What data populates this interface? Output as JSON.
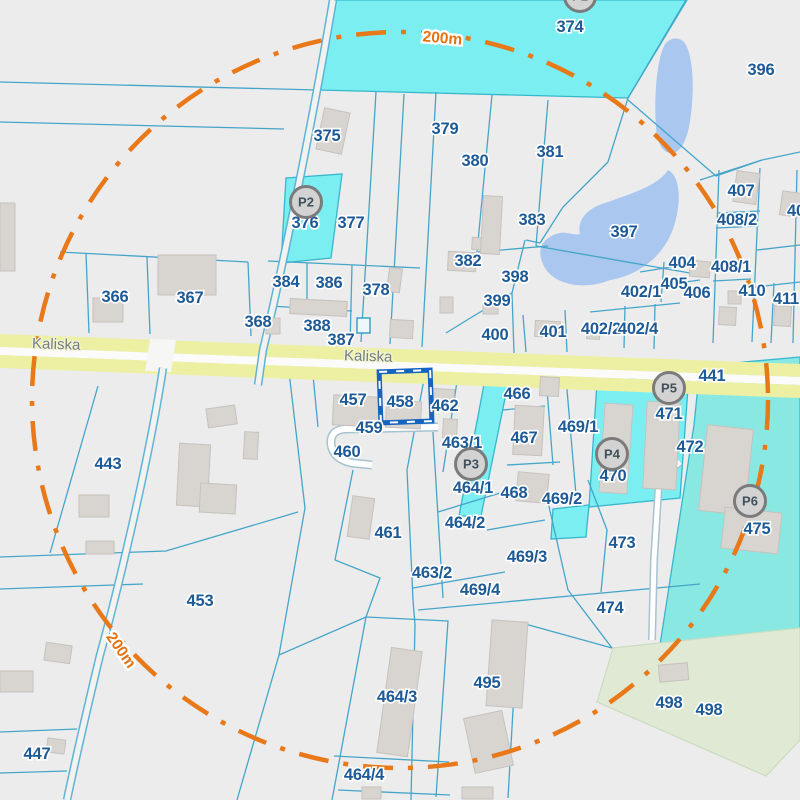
{
  "map": {
    "road": {
      "name": "Kaliska",
      "labels": [
        {
          "text": "Kaliska",
          "x": 56,
          "y": 349,
          "rotate": 2
        },
        {
          "text": "Kaliska",
          "x": 368,
          "y": 361,
          "rotate": 2
        }
      ]
    },
    "ring": {
      "radius_text": "200m",
      "labels": [
        {
          "text": "200m",
          "x": 442,
          "y": 43,
          "rotate": 5
        },
        {
          "text": "200m",
          "x": 117,
          "y": 653,
          "rotate": 55
        }
      ]
    },
    "selected_parcel": "458",
    "markers": [
      {
        "label": "P1",
        "x": 580,
        "y": -4
      },
      {
        "label": "P2",
        "x": 306,
        "y": 202
      },
      {
        "label": "P3",
        "x": 471,
        "y": 464
      },
      {
        "label": "P4",
        "x": 612,
        "y": 454
      },
      {
        "label": "P5",
        "x": 669,
        "y": 388
      },
      {
        "label": "P6",
        "x": 750,
        "y": 501
      }
    ],
    "parcels": [
      {
        "label": "374",
        "x": 570,
        "y": 32
      },
      {
        "label": "396",
        "x": 761,
        "y": 75
      },
      {
        "label": "375",
        "x": 327,
        "y": 141
      },
      {
        "label": "379",
        "x": 445,
        "y": 134
      },
      {
        "label": "380",
        "x": 475,
        "y": 166
      },
      {
        "label": "381",
        "x": 550,
        "y": 157
      },
      {
        "label": "376",
        "x": 305,
        "y": 228
      },
      {
        "label": "377",
        "x": 351,
        "y": 228
      },
      {
        "label": "383",
        "x": 532,
        "y": 225
      },
      {
        "label": "397",
        "x": 624,
        "y": 237
      },
      {
        "label": "382",
        "x": 468,
        "y": 266
      },
      {
        "label": "398",
        "x": 515,
        "y": 282
      },
      {
        "label": "399",
        "x": 497,
        "y": 306
      },
      {
        "label": "400",
        "x": 495,
        "y": 340
      },
      {
        "label": "401",
        "x": 553,
        "y": 337
      },
      {
        "label": "402/1",
        "x": 641,
        "y": 297
      },
      {
        "label": "402/2",
        "x": 601,
        "y": 334
      },
      {
        "label": "402/4",
        "x": 638,
        "y": 334
      },
      {
        "label": "404",
        "x": 682,
        "y": 268
      },
      {
        "label": "405",
        "x": 674,
        "y": 289
      },
      {
        "label": "406",
        "x": 697,
        "y": 298
      },
      {
        "label": "407",
        "x": 741,
        "y": 196
      },
      {
        "label": "408/2",
        "x": 737,
        "y": 225
      },
      {
        "label": "408/1",
        "x": 731,
        "y": 272
      },
      {
        "label": "410",
        "x": 752,
        "y": 296
      },
      {
        "label": "411",
        "x": 786,
        "y": 304
      },
      {
        "label": "40",
        "x": 796,
        "y": 216
      },
      {
        "label": "366",
        "x": 115,
        "y": 302
      },
      {
        "label": "367",
        "x": 190,
        "y": 303
      },
      {
        "label": "368",
        "x": 258,
        "y": 327
      },
      {
        "label": "384",
        "x": 286,
        "y": 287
      },
      {
        "label": "386",
        "x": 329,
        "y": 288
      },
      {
        "label": "378",
        "x": 376,
        "y": 295
      },
      {
        "label": "388",
        "x": 317,
        "y": 331
      },
      {
        "label": "387",
        "x": 341,
        "y": 345
      },
      {
        "label": "441",
        "x": 712,
        "y": 381
      },
      {
        "label": "457",
        "x": 353,
        "y": 405
      },
      {
        "label": "458",
        "x": 400,
        "y": 407
      },
      {
        "label": "459",
        "x": 369,
        "y": 433
      },
      {
        "label": "462",
        "x": 445,
        "y": 411
      },
      {
        "label": "460",
        "x": 347,
        "y": 457
      },
      {
        "label": "463/1",
        "x": 462,
        "y": 448
      },
      {
        "label": "466",
        "x": 517,
        "y": 399
      },
      {
        "label": "467",
        "x": 524,
        "y": 443
      },
      {
        "label": "469/1",
        "x": 578,
        "y": 432
      },
      {
        "label": "464/1",
        "x": 473,
        "y": 493
      },
      {
        "label": "468",
        "x": 514,
        "y": 498
      },
      {
        "label": "469/2",
        "x": 562,
        "y": 504
      },
      {
        "label": "470",
        "x": 613,
        "y": 481
      },
      {
        "label": "471",
        "x": 669,
        "y": 419
      },
      {
        "label": "472",
        "x": 690,
        "y": 452
      },
      {
        "label": "475",
        "x": 757,
        "y": 534
      },
      {
        "label": "443",
        "x": 108,
        "y": 469
      },
      {
        "label": "453",
        "x": 200,
        "y": 606
      },
      {
        "label": "461",
        "x": 388,
        "y": 538
      },
      {
        "label": "464/2",
        "x": 465,
        "y": 528
      },
      {
        "label": "463/2",
        "x": 432,
        "y": 578
      },
      {
        "label": "469/3",
        "x": 527,
        "y": 562
      },
      {
        "label": "469/4",
        "x": 480,
        "y": 595
      },
      {
        "label": "473",
        "x": 622,
        "y": 548
      },
      {
        "label": "474",
        "x": 610,
        "y": 613
      },
      {
        "label": "464/3",
        "x": 397,
        "y": 702
      },
      {
        "label": "495",
        "x": 487,
        "y": 688
      },
      {
        "label": "498",
        "x": 669,
        "y": 708
      },
      {
        "label": "498",
        "x": 709,
        "y": 715
      },
      {
        "label": "464/4",
        "x": 364,
        "y": 780
      },
      {
        "label": "447",
        "x": 37,
        "y": 759
      }
    ],
    "colors": {
      "highlight_parcel_border": "#1565c0",
      "ring_orange": "#e87818",
      "selected_cyan": "#7beef2",
      "big_cyan": "#89e9e2",
      "water_blue": "#a9c7ef",
      "road_yellow": "#edf0a3",
      "green_area": "#dfe9d3",
      "label_navy": "#1d5a96"
    }
  }
}
